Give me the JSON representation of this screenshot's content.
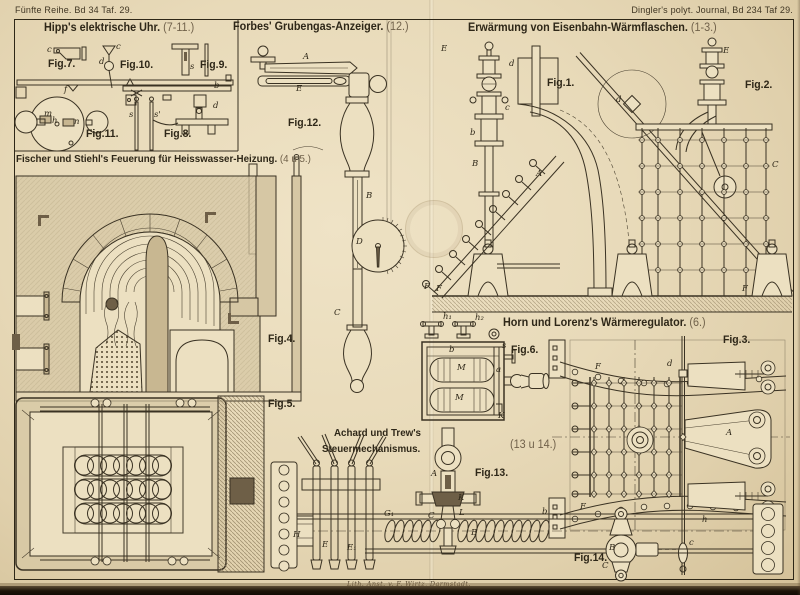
{
  "page": {
    "header_left": "Fünfte Reihe. Bd 34 Taf. 29.",
    "header_right": "Dingler's polyt. Journal, Bd 234 Taf 29.",
    "credit": "Lith. Anst. v. F. Wirtz, Darmstadt.",
    "colors": {
      "paper": "#e8dab9",
      "ink": "#3a3223",
      "masonry": "#d6c7a4",
      "page_edge": "#1d1409"
    }
  },
  "sections": {
    "hipp": {
      "title": "Hipp's elektrische Uhr.",
      "ref": "(7-11.)"
    },
    "forbes": {
      "title": "Forbes' Grubengas-Anzeiger.",
      "ref": "(12.)"
    },
    "erwaermung": {
      "title": "Erwärmung von Eisenbahn-Wärmflaschen.",
      "ref": "(1-3.)"
    },
    "fischer": {
      "title": "Fischer und Stiehl's Feuerung für Heisswasser-Heizung.",
      "ref": "(4 u 5.)"
    },
    "horn": {
      "title": "Horn und Lorenz's Wärmeregulator.",
      "ref": "(6.)"
    },
    "achard": {
      "title_line1": "Achard und Trew's",
      "title_line2": "Steuermechanismus.",
      "ref": "(13 u 14.)"
    }
  },
  "fig_labels": {
    "fig1": "Fig.1.",
    "fig2": "Fig.2.",
    "fig3": "Fig.3.",
    "fig4": "Fig.4.",
    "fig5": "Fig.5.",
    "fig6": "Fig.6.",
    "fig7": "Fig.7.",
    "fig8": "Fig.8.",
    "fig9": "Fig.9.",
    "fig10": "Fig.10.",
    "fig11": "Fig.11.",
    "fig12": "Fig.12.",
    "fig13": "Fig.13.",
    "fig14": "Fig.14."
  },
  "part_labels": {
    "f7_c": "c",
    "f7_f": "f",
    "f10_c": "c",
    "f10_d": "d",
    "f9_s": "s",
    "f9_b": "b",
    "f11_m": "m",
    "f11_h": "h",
    "f11_n": "n",
    "f8_s": "s",
    "f8_s1": "s'",
    "f8_d": "d",
    "f12_A": "A",
    "f12_E": "E",
    "f12_B": "B",
    "f12_D": "D",
    "f12_C": "C",
    "f12_F": "F",
    "f1_E": "E",
    "f1_d": "d",
    "f1_c": "c",
    "f1_b": "b",
    "f1_B": "B",
    "f1_A": "A",
    "f1_F": "F",
    "f2_E": "E",
    "f2_d": "d",
    "f2_C": "C",
    "f2_F": "F",
    "f6_h1": "h₁",
    "f6_h2": "h₂",
    "f6_b": "b",
    "f6_M1": "M",
    "f6_M2": "M",
    "f6_a": "a",
    "f6_s": "s",
    "f6_K": "K",
    "f3_F1": "F",
    "f3_F2": "F",
    "f3_A": "A",
    "f3_d": "d",
    "f3_h": "h",
    "f3_C": "c",
    "f13_H": "H",
    "f13_E": "E",
    "f13_E1": "E₁",
    "f13_G1": "G₁",
    "f13_A": "A",
    "f13_K": "K",
    "f13_L": "L",
    "f13_C": "C",
    "f13_B": "B",
    "f13_b": "b",
    "f14_B": "B",
    "f14_C": "C"
  }
}
